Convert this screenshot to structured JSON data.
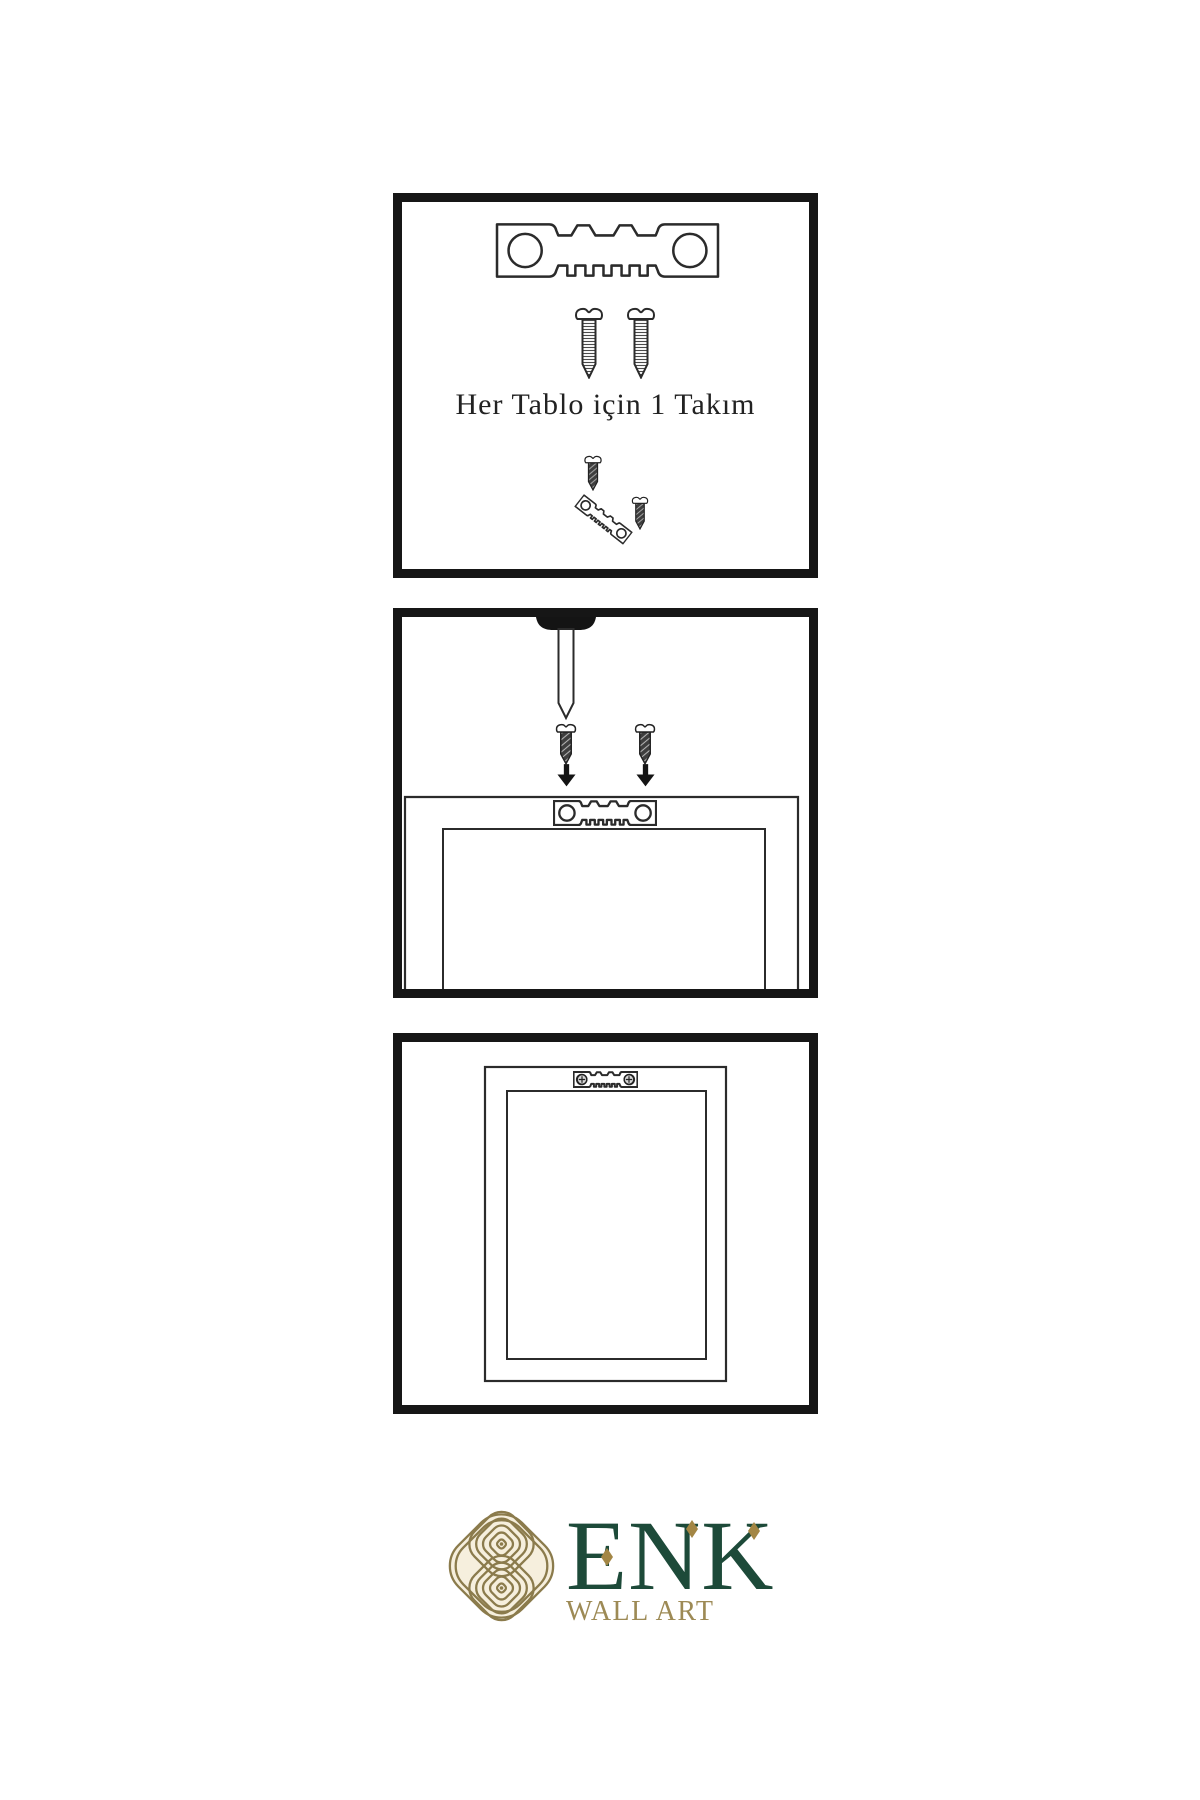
{
  "instructions": {
    "panel1": {
      "caption": "Her Tablo için 1 Takım",
      "illustrations": [
        "sawtooth-hanger",
        "mounting-screw",
        "mounting-screw",
        "small-screw",
        "tilted-hanger",
        "small-screw"
      ]
    },
    "panel2": {
      "illustrations": [
        "wall-nail",
        "screw-with-arrow",
        "screw-with-arrow",
        "frame-back-with-sawtooth-hanger"
      ]
    },
    "panel3": {
      "illustrations": [
        "hung-frame-with-mounted-hanger"
      ]
    }
  },
  "logo": {
    "brand": "ENK",
    "subtitle": "WALL ART",
    "colors": {
      "brand_green": "#1d4a39",
      "text_gold": "#9d8a55",
      "emblem_gold": "#8b7b4c",
      "emblem_background": "#f6efdd",
      "accent_diamond": "#a38644"
    }
  },
  "colors": {
    "background": "#ffffff",
    "panel_border": "#161616",
    "line": "#2b2b2b",
    "screw_dark": "#3e3e3e"
  }
}
